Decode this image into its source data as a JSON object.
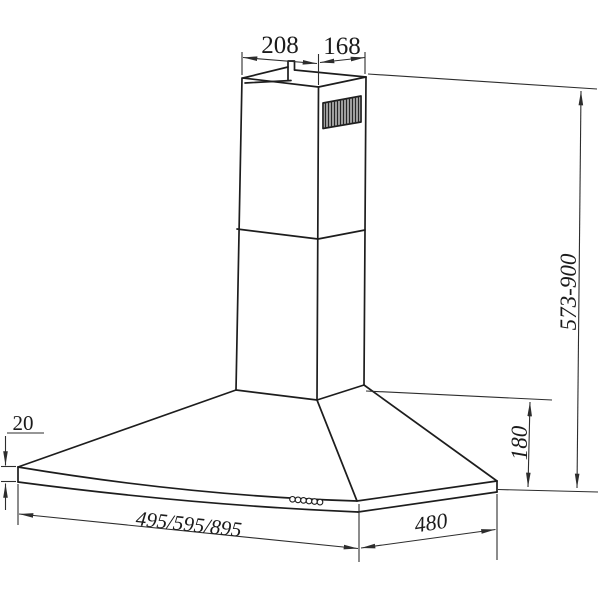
{
  "drawing": {
    "subject": "wall-mounted chimney cooker hood - installation dimension drawing",
    "units": "mm",
    "labels": {
      "chimney_width": "208",
      "chimney_depth": "168",
      "overall_height_range": "573-900",
      "canopy_height": "180",
      "rim_height": "20",
      "body_width_options": "495/595/895",
      "body_depth": "480"
    },
    "features": {
      "vent_grille": "louvre slots on upper chimney right face",
      "control_buttons": "6 round push buttons on front rim",
      "mounting_tab": "hanging bracket tab on chimney top"
    },
    "colors": {
      "background": "#ffffff",
      "object_line": "#1d1d1d",
      "dimension_line": "#2d2d2d"
    }
  }
}
